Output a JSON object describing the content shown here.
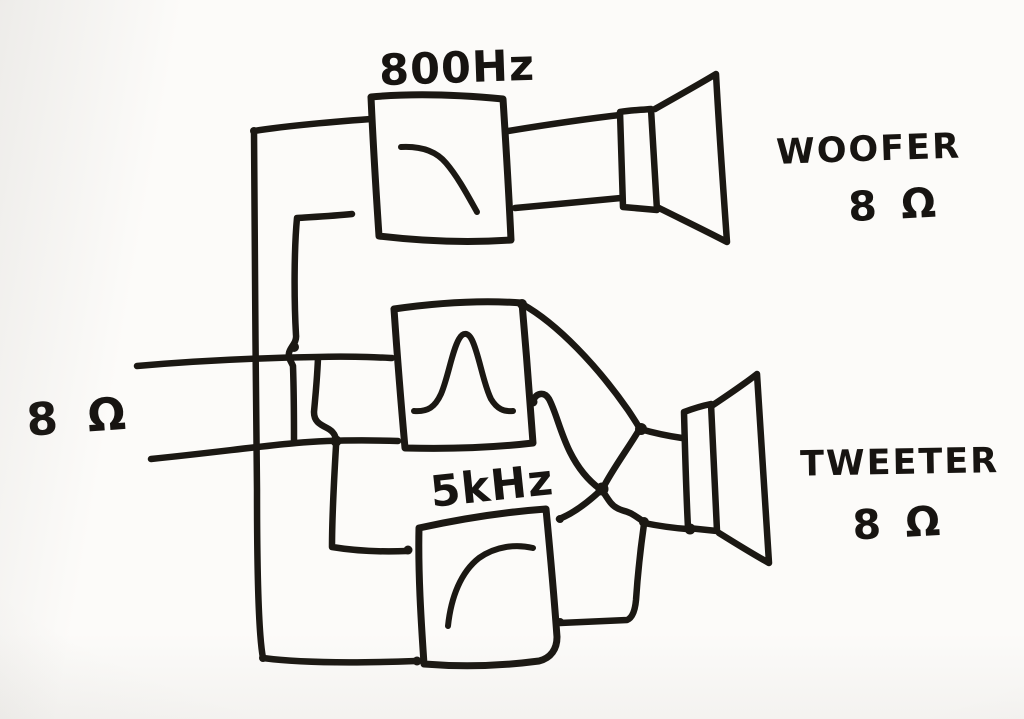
{
  "diagram": {
    "input": {
      "impedance_label": "8 Ω"
    },
    "filters": {
      "lowpass": {
        "frequency_label": "800Hz",
        "curve_icon": "low-pass-curve-icon"
      },
      "bandpass": {
        "curve_icon": "band-pass-curve-icon"
      },
      "highpass": {
        "frequency_label": "5kHz",
        "curve_icon": "high-pass-curve-icon"
      }
    },
    "drivers": {
      "woofer": {
        "name_label": "WOOFER",
        "impedance_label": "8 Ω"
      },
      "tweeter": {
        "name_label": "TWEETER",
        "impedance_label": "8 Ω"
      }
    },
    "colors": {
      "ink": "#1b1813",
      "paper": "#fcfbf9"
    }
  }
}
